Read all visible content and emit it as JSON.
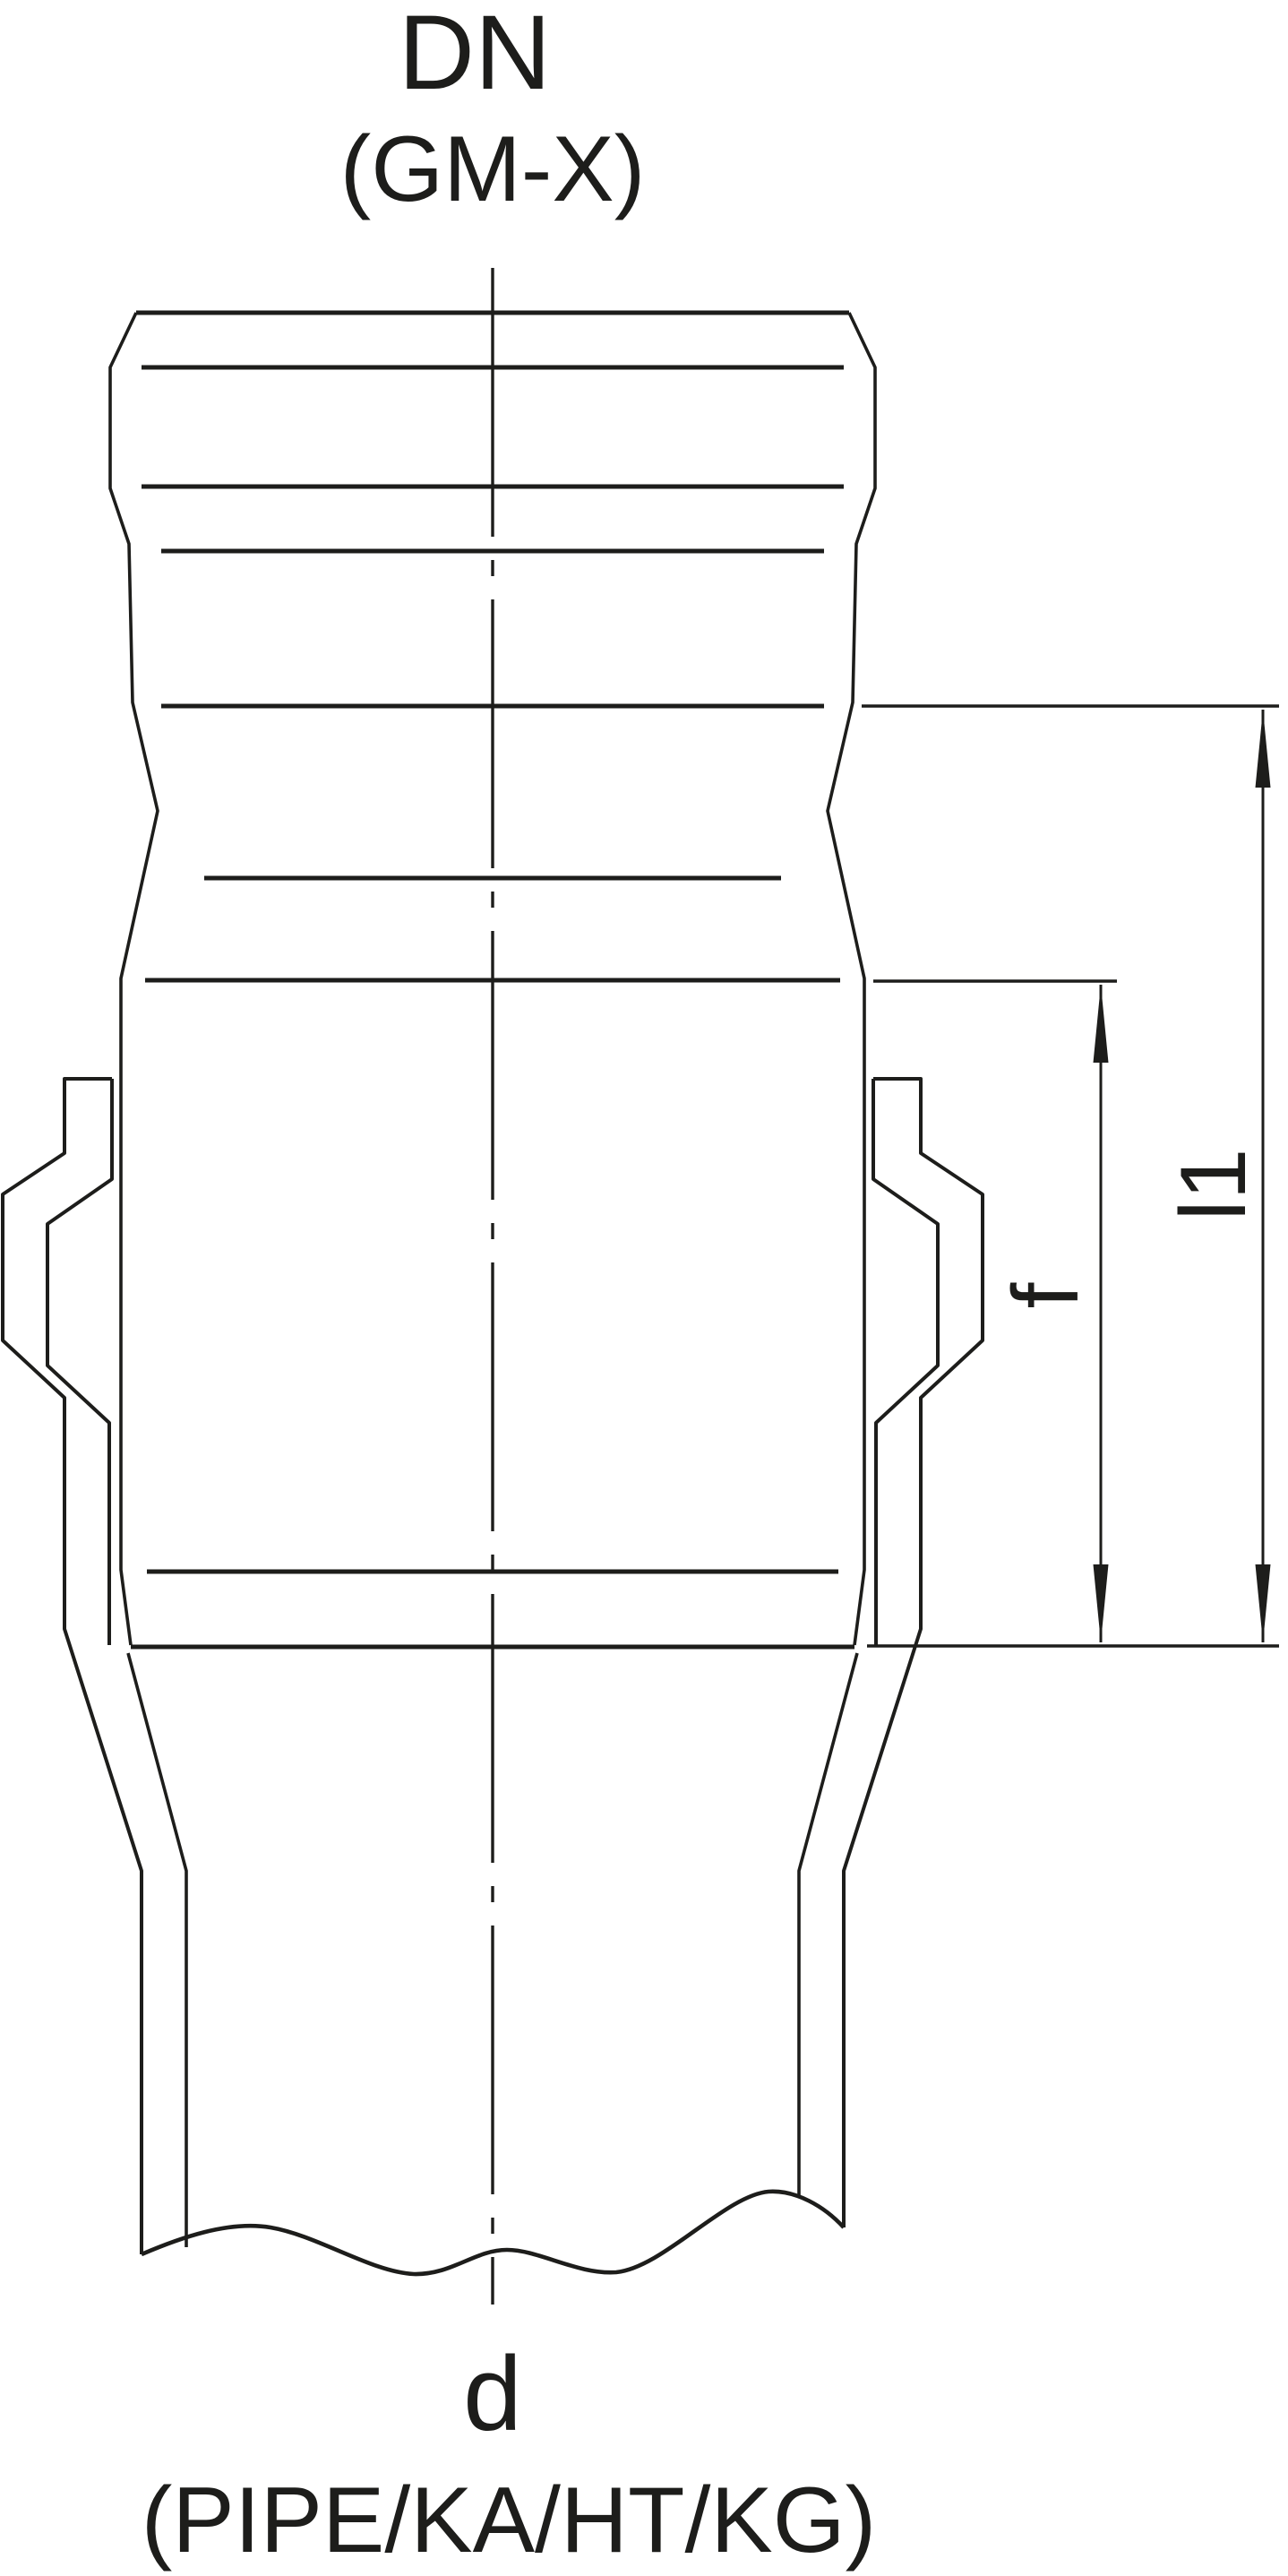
{
  "figure": {
    "type": "pipe-socket-technical-drawing",
    "top_axis_label": "DN",
    "top_axis_sublabel": "(GM-X)",
    "bottom_axis_label": "d",
    "bottom_axis_sublabel": "(PIPE/KA/HT/KG)",
    "dimension_labels": {
      "insertion_depth": "f",
      "socket_length": "l1"
    }
  },
  "colors": {
    "line": "#1d1d1b",
    "background": "#ffffff"
  }
}
